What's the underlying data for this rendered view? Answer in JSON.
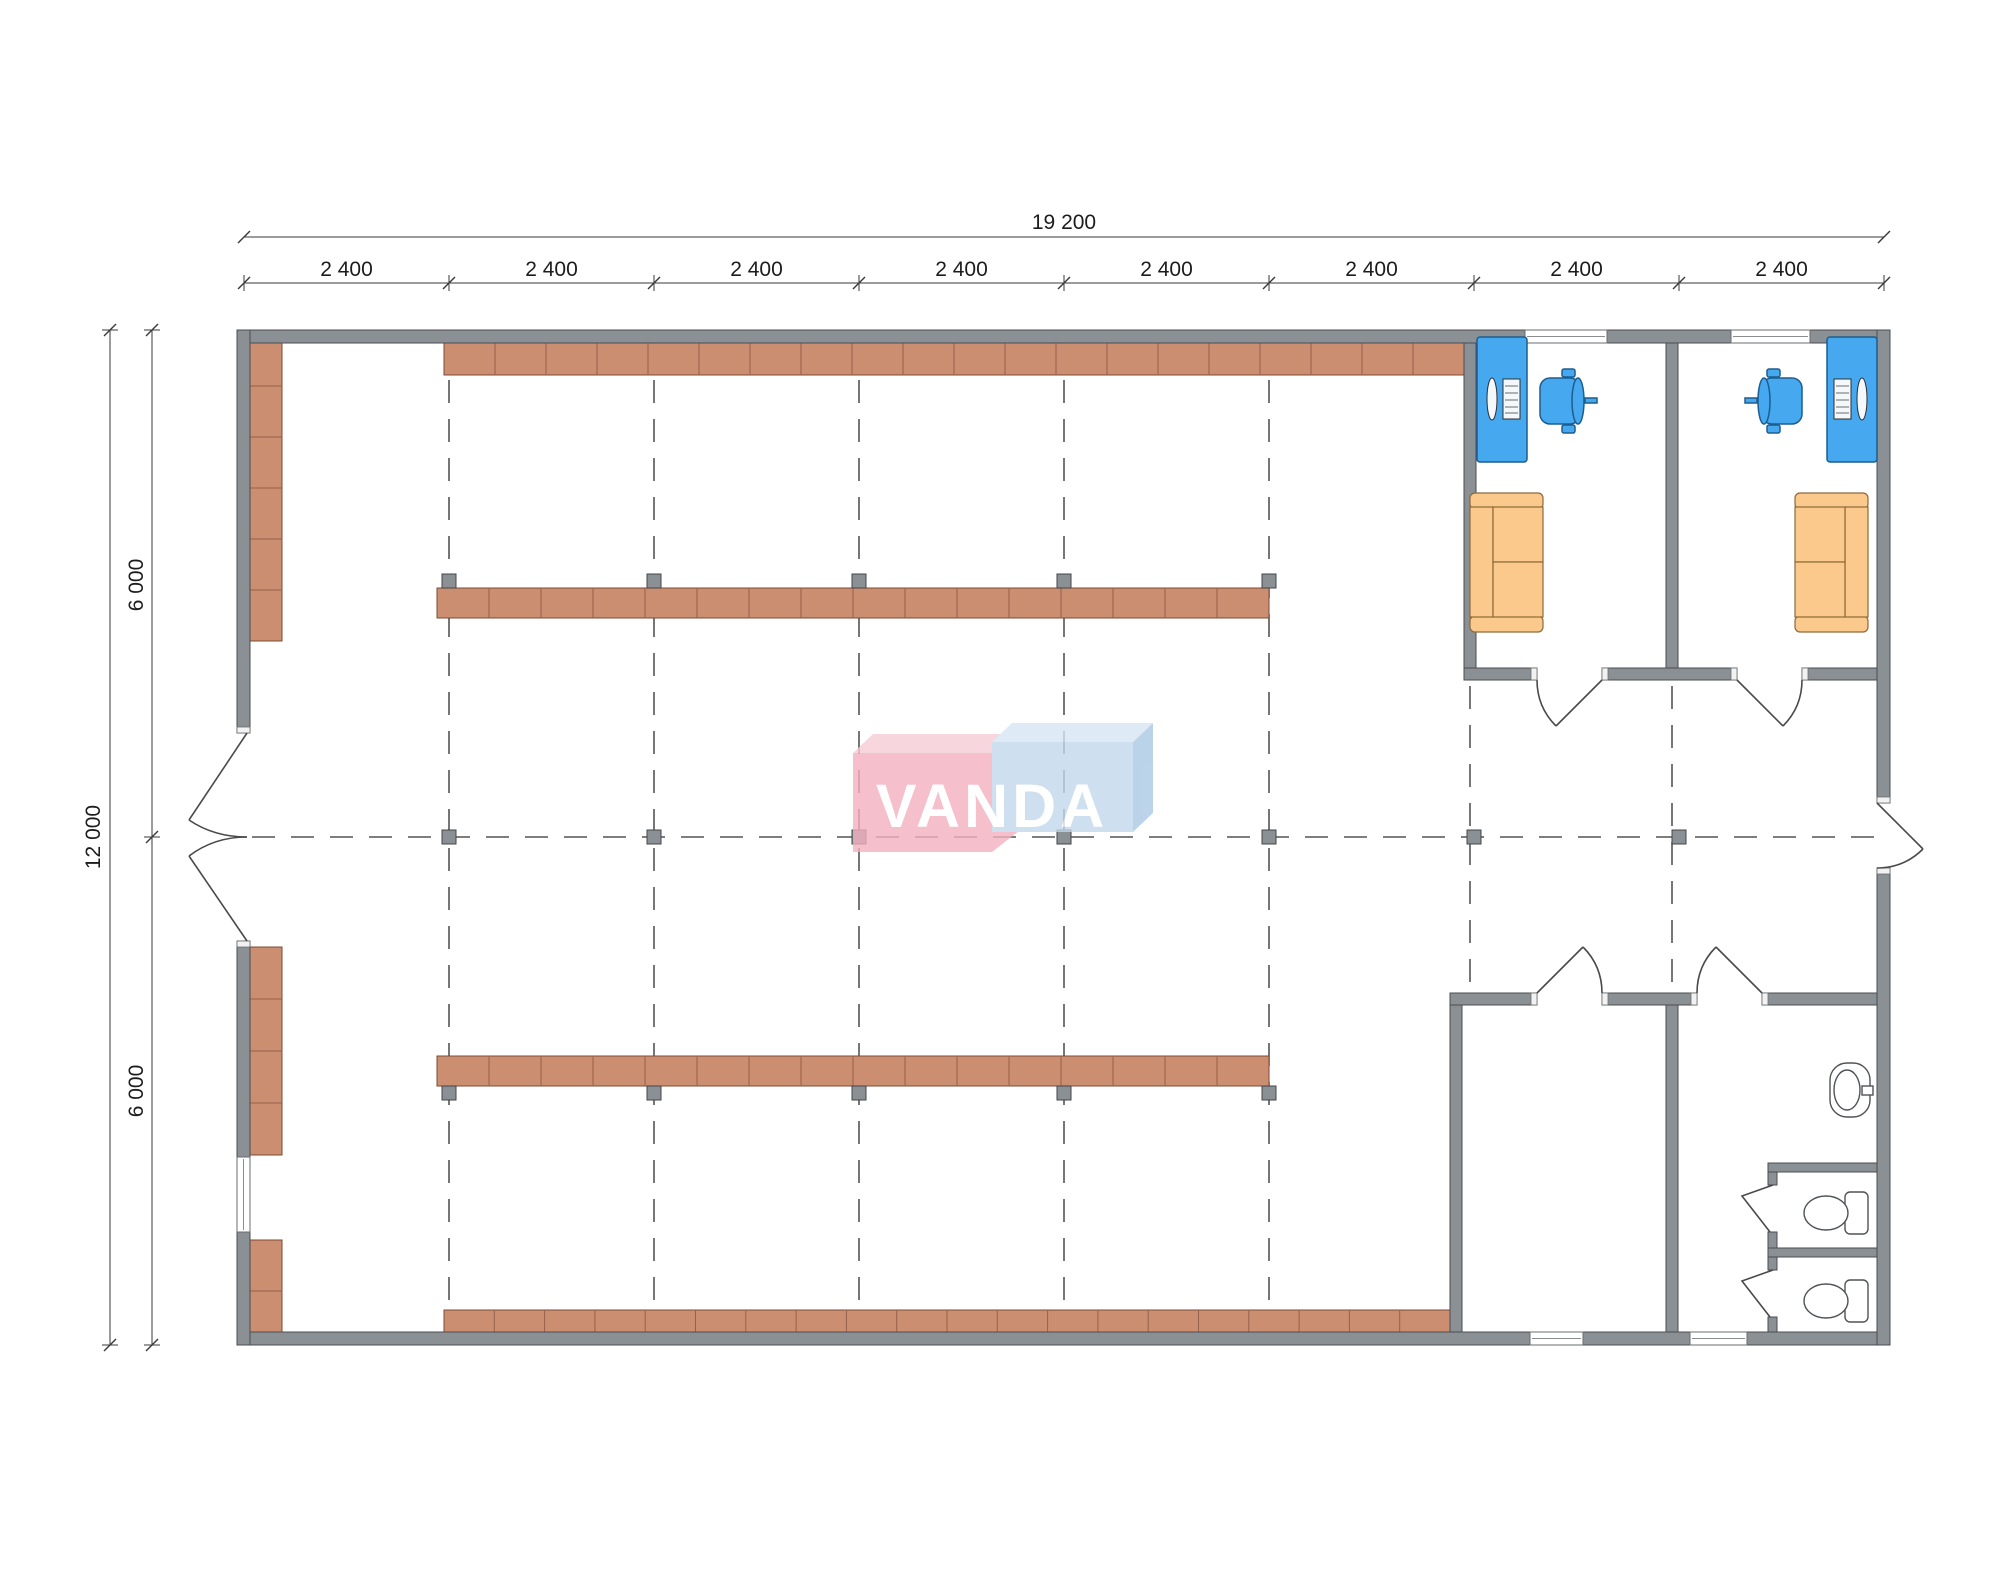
{
  "dimensions": {
    "total_width": "19 200",
    "bays": [
      "2 400",
      "2 400",
      "2 400",
      "2 400",
      "2 400",
      "2 400",
      "2 400",
      "2 400"
    ],
    "total_height": "12 000",
    "height_halves": [
      "6 000",
      "6 000"
    ]
  },
  "logo": {
    "text": "VANDA",
    "pink_front": "#f3b0bf",
    "pink_top": "#f7ccd5",
    "blue_front": "#c2d8ec",
    "blue_top": "#d6e7f5",
    "blue_side": "#abc9e3",
    "text_color": "#ffffff"
  },
  "colors": {
    "wall": "#8b9095",
    "wall_outline": "#4b4e52",
    "shelf": "#cb8e71",
    "shelf_outline": "#7d4b33",
    "shelf_divider": "#95604a",
    "column": "#8b9095",
    "desk": "#46a8ef",
    "chair": "#46a8ef",
    "sofa": "#fbc98c",
    "sofa_outline": "#8a6a3a",
    "grid_dash": "#545454",
    "dimension": "#3a3a3a"
  }
}
